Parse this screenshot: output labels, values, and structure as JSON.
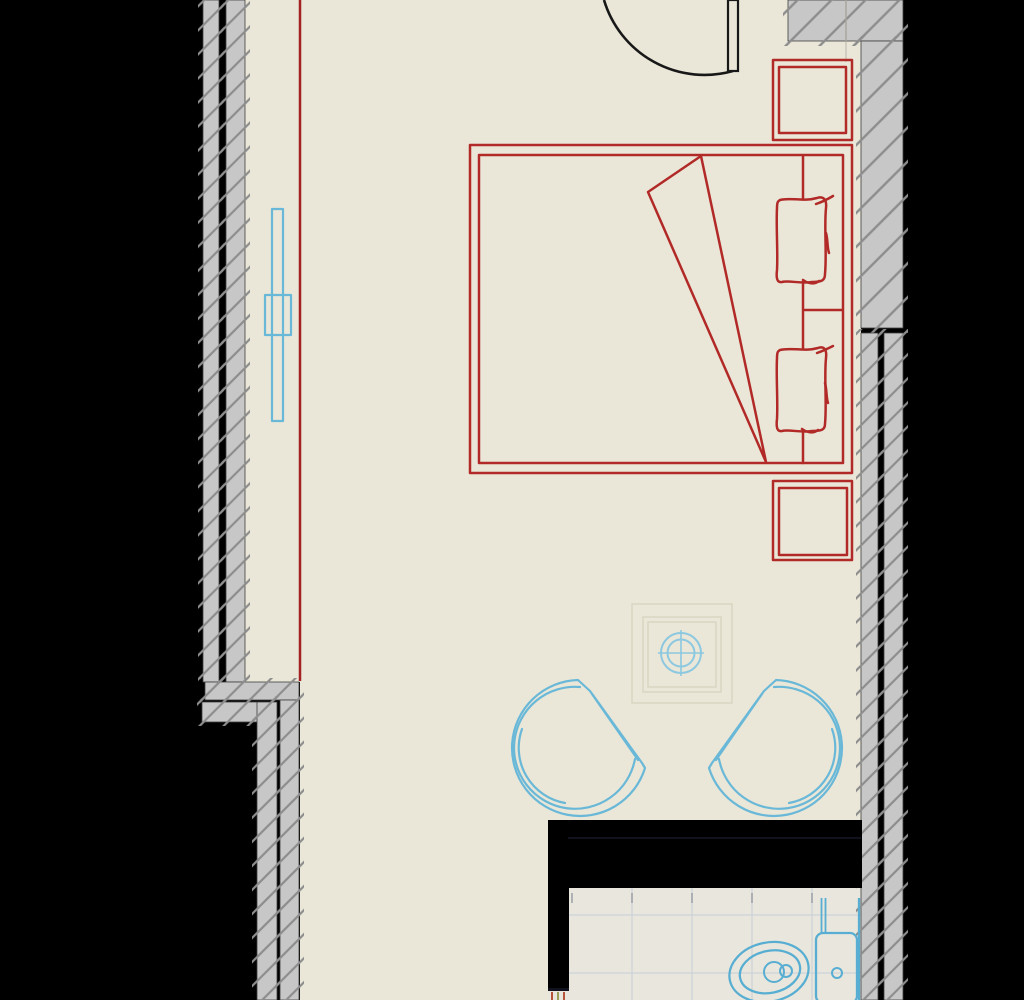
{
  "scene": {
    "kind": "architectural-floor-plan",
    "room": "bedroom-with-ensuite-bathroom",
    "elements": [
      {
        "name": "left-exterior-wall",
        "style": "double-leaf hatched wall with insulation gap"
      },
      {
        "name": "left-wall-jog",
        "style": "stepped wall offset"
      },
      {
        "name": "right-exterior-wall",
        "style": "hatched wall, solid above, double-leaf below"
      },
      {
        "name": "top-right-wall-block",
        "style": "hatched masonry block"
      },
      {
        "name": "entry-door",
        "style": "door leaf with quarter-circle swing arc"
      },
      {
        "name": "red-boundary-line",
        "style": "vertical red line along left wall"
      },
      {
        "name": "radiator",
        "style": "cyan wall-mounted radiator symbol"
      },
      {
        "name": "double-bed",
        "style": "red outline bed with mattress, fold-back blanket triangle, two pillows"
      },
      {
        "name": "nightstand-top",
        "style": "red double-outline square"
      },
      {
        "name": "nightstand-bottom",
        "style": "red double-outline square"
      },
      {
        "name": "ceiling-light",
        "style": "cyan crosshair circles over faint recessed square"
      },
      {
        "name": "armchair-left",
        "style": "cyan round-back tub chair"
      },
      {
        "name": "armchair-right",
        "style": "cyan round-back tub chair"
      },
      {
        "name": "service-duct",
        "style": "solid black wall mass above bathroom"
      },
      {
        "name": "bathroom-floor",
        "style": "tiled floor grid"
      },
      {
        "name": "toilet",
        "style": "cyan toilet with cistern against right wall"
      },
      {
        "name": "threshold-ticks",
        "style": "small red section marks at duct foot"
      }
    ]
  },
  "palette": {
    "background": "#000000",
    "floor": "#eae7d8",
    "bathroom_floor": "#e9e7dd",
    "wall_fill": "#c7c7c7",
    "wall_hatch": "#8d8d8d",
    "wall_edge": "#3f3f3f",
    "furniture_red": "#b22a28",
    "red_line": "#a32121",
    "cyan_furniture": "#6ab8d8",
    "cyan_fixture": "#8cc8e0",
    "toilet_cyan": "#58aed2",
    "door_black": "#181818",
    "ceiling_square": "#d8d4c2",
    "tile_grid": "#ccd2d8",
    "tile_tick": "#9aa0a6",
    "duct_black": "#000000",
    "duct_hidden_line": "#10121e",
    "threshold_tick_red": "#b5543b",
    "threshold_tick_olive": "#9aa05a",
    "block_divider": "#a6a69c"
  }
}
